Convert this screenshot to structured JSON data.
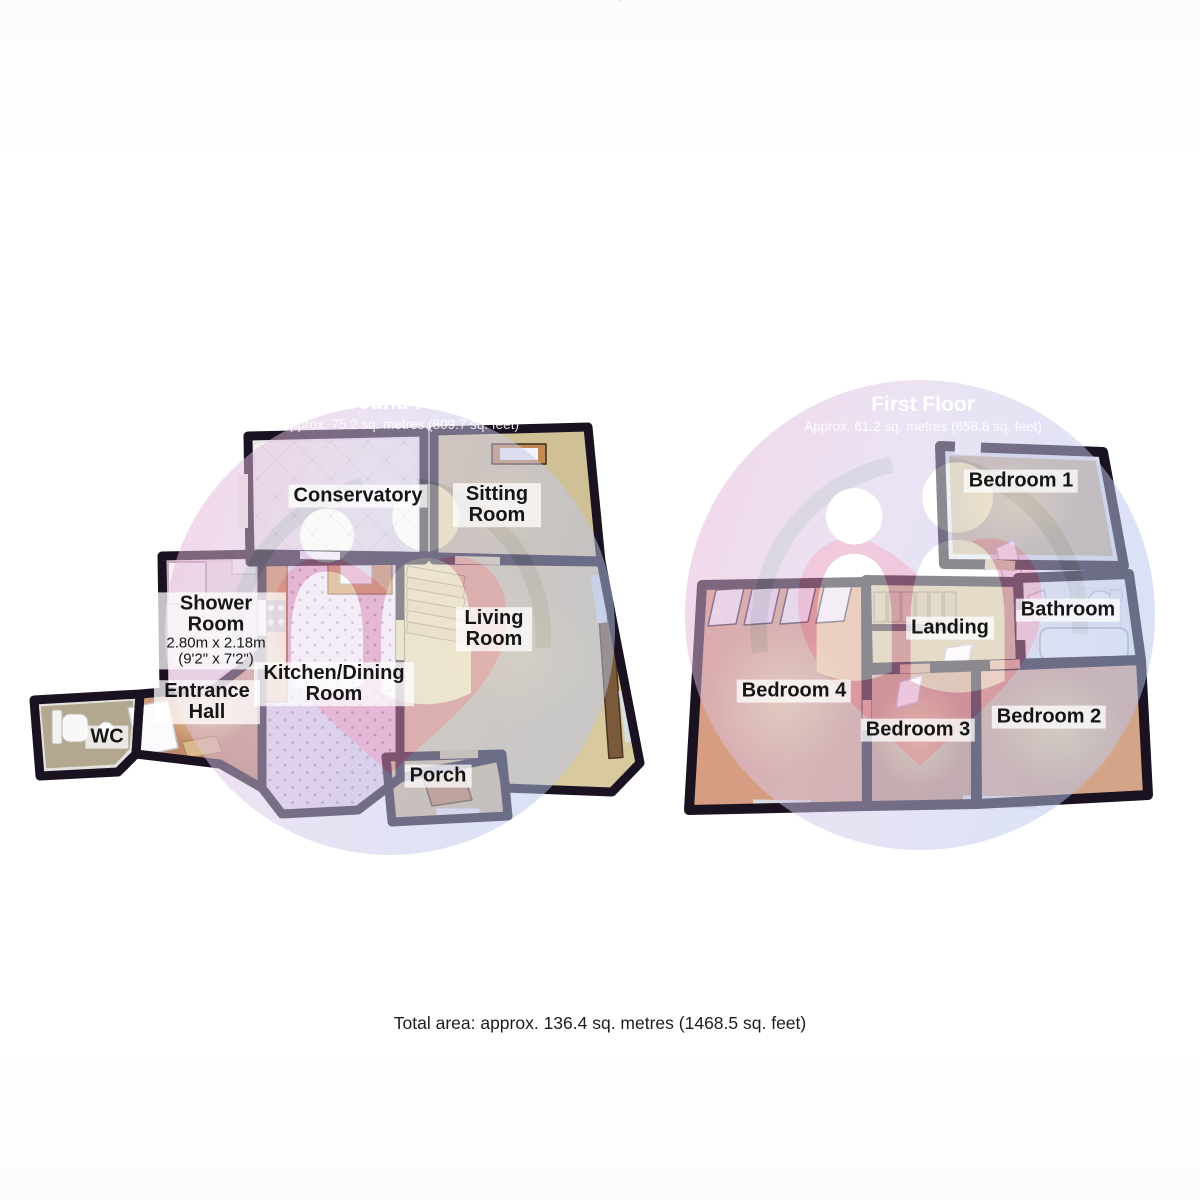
{
  "footer": {
    "total_area": "Total area: approx. 136.4 sq. metres (1468.5 sq. feet)"
  },
  "ground_floor": {
    "title": "Ground Floor",
    "subtitle": "Approx. 75.2 sq. metres (809.7 sq. feet)",
    "rooms": {
      "conservatory": {
        "label": "Conservatory"
      },
      "sitting_room": {
        "label": "Sitting Room"
      },
      "shower_room": {
        "label": "Shower Room",
        "dimensions_metric": "2.80m x 2.18m",
        "dimensions_imperial": "(9'2\" x 7'2\")"
      },
      "kitchen_dining": {
        "label": "Kitchen/Dining Room"
      },
      "living_room": {
        "label": "Living Room"
      },
      "entrance_hall": {
        "label": "Entrance Hall"
      },
      "wc": {
        "label": "WC"
      },
      "porch": {
        "label": "Porch"
      }
    }
  },
  "first_floor": {
    "title": "First Floor",
    "subtitle": "Approx. 61.2 sq. metres (658.8 sq. feet)",
    "rooms": {
      "bedroom_1": {
        "label": "Bedroom 1"
      },
      "bathroom": {
        "label": "Bathroom"
      },
      "landing": {
        "label": "Landing"
      },
      "bedroom_4": {
        "label": "Bedroom 4"
      },
      "bedroom_3": {
        "label": "Bedroom 3"
      },
      "bedroom_2": {
        "label": "Bedroom 2"
      }
    }
  },
  "colors": {
    "wall": "#1a1220",
    "label_background": "rgba(255,255,255,0.74)",
    "watermark_pink": "#e8aed0",
    "watermark_blue": "#b9c7ee",
    "floor_beige": "#d8c99f",
    "floor_salmon": "#d59d82",
    "kitchen_tile": "#e9daee"
  }
}
